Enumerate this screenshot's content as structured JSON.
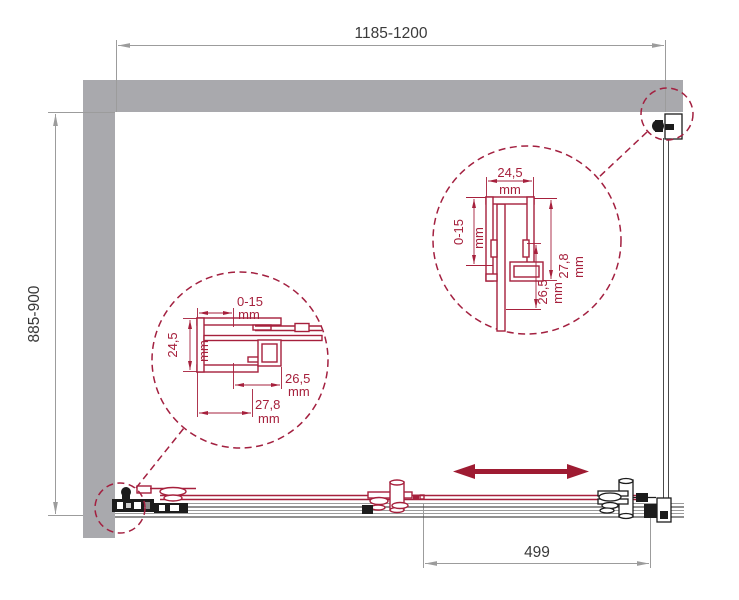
{
  "drawing": {
    "type": "shower-enclosure-installation-diagram",
    "view": "top-plan"
  },
  "colors": {
    "wall": "#a9a9ad",
    "red": "#a6203c",
    "circle_red": "#a32040",
    "arrow_red": "#9e1b32",
    "dim_line": "#9c9c9c",
    "dim_text": "#3a3a3a",
    "dark": "#1c1c1c"
  },
  "dimensions": {
    "width_top": "1185-1200",
    "depth_left": "885-900",
    "door_width": "499"
  },
  "detail_left": {
    "adjust": "0-15",
    "adjust_unit": "mm",
    "width": "24,5",
    "width_unit": "mm",
    "inner": "26,5",
    "inner_unit": "mm",
    "outer": "27,8",
    "outer_unit": "mm"
  },
  "detail_right": {
    "width": "24,5",
    "width_unit": "mm",
    "adjust": "0-15",
    "adjust_unit": "mm",
    "outer": "27,8",
    "outer_unit": "mm",
    "inner": "26,5",
    "inner_unit": "mm"
  },
  "icons": {
    "slide_arrow": "double-headed-arrow"
  }
}
